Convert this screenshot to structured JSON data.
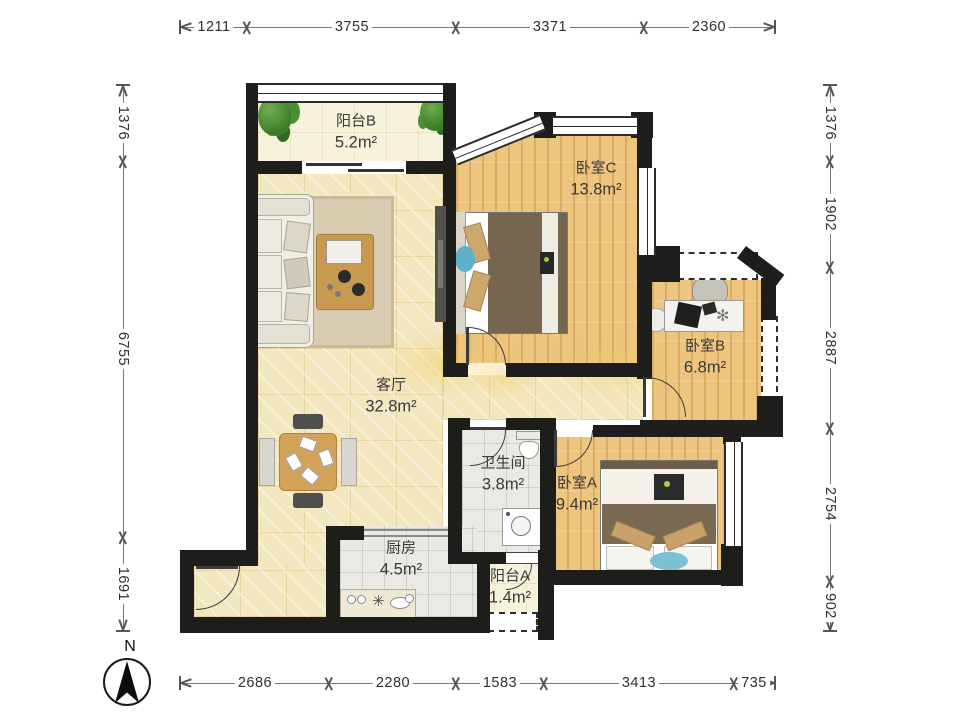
{
  "compass": {
    "label": "N"
  },
  "icons": {
    "stove": "✳",
    "desk_plant": "✻"
  },
  "dimensions": {
    "top": [
      "1211",
      "3755",
      "3371",
      "2360"
    ],
    "bottom": [
      "2686",
      "2280",
      "1583",
      "3413",
      "735"
    ],
    "left": [
      "1376",
      "6755",
      "1691"
    ],
    "right": [
      "1376",
      "1902",
      "2887",
      "2754",
      "902"
    ]
  },
  "rooms": {
    "balcony_b": {
      "name": "阳台B",
      "area": "5.2m²"
    },
    "bedroom_c": {
      "name": "卧室C",
      "area": "13.8m²"
    },
    "bedroom_b": {
      "name": "卧室B",
      "area": "6.8m²"
    },
    "living_room": {
      "name": "客厅",
      "area": "32.8m²"
    },
    "bathroom": {
      "name": "卫生间",
      "area": "3.8m²"
    },
    "bedroom_a": {
      "name": "卧室A",
      "area": "9.4m²"
    },
    "kitchen": {
      "name": "厨房",
      "area": "4.5m²"
    },
    "balcony_a": {
      "name": "阳台A",
      "area": "1.4m²"
    }
  },
  "colors": {
    "wall": "#1d1d1b",
    "wood_floor": "#edc57f",
    "tile_floor": "#f3e7c0",
    "gray_floor": "#eae9e4",
    "cream_floor": "#f6f2dc",
    "accent_teal": "#7cc0d4",
    "dim_text": "#2f2f2f"
  }
}
